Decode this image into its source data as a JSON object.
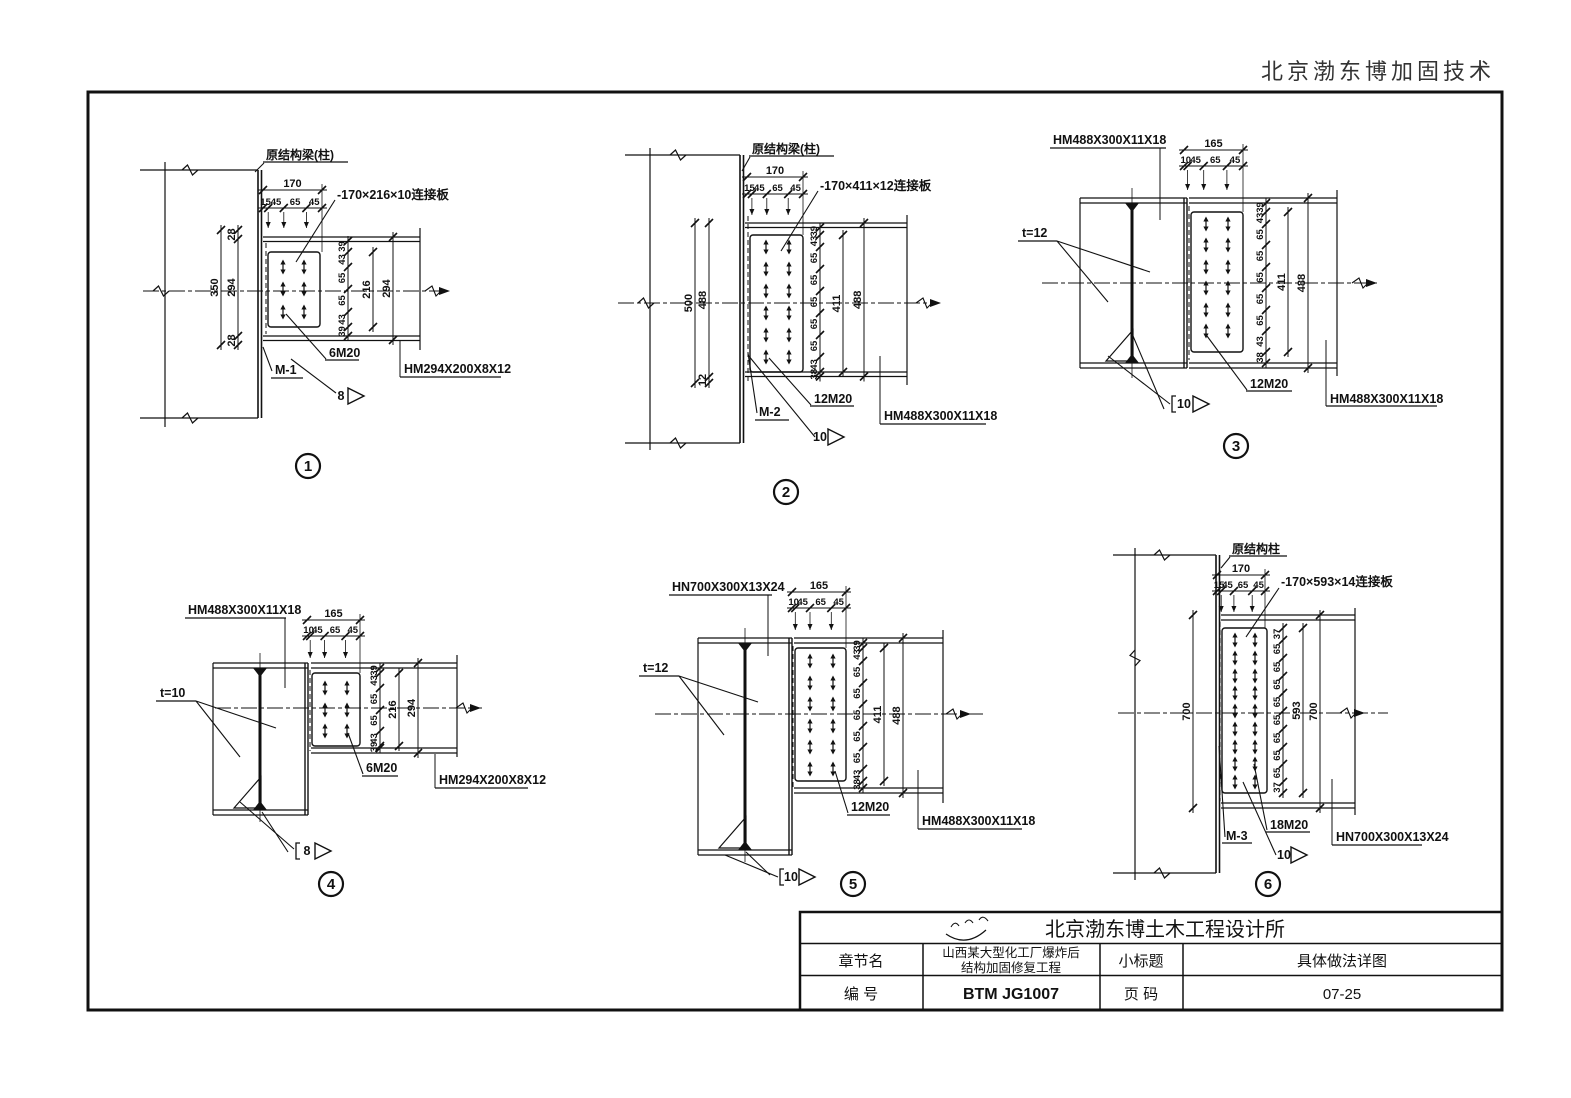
{
  "page": {
    "brand": "北京渤东博加固技术"
  },
  "details": [
    {
      "number": "1",
      "support": "原结构梁(柱)",
      "plate": "-170×216×10连接板",
      "bolts": "6M20",
      "mark": "M-1",
      "weld": "8",
      "beam": "HM294X200X8X12",
      "top_total": "170",
      "top_chain": [
        "15",
        "45",
        "65",
        "45"
      ],
      "left_overall": "350",
      "left_chain": [
        "28",
        "294",
        "28"
      ],
      "right_chain": [
        "39",
        "43",
        "65",
        "65",
        "43",
        "39"
      ],
      "plate_h": "216",
      "depth": "294"
    },
    {
      "number": "2",
      "support": "原结构梁(柱)",
      "plate": "-170×411×12连接板",
      "bolts": "12M20",
      "mark": "M-2",
      "weld": "10",
      "beam": "HM488X300X11X18",
      "top_total": "170",
      "top_chain": [
        "15",
        "45",
        "65",
        "45"
      ],
      "left_overall": "500",
      "left_chain": [
        "488",
        "12"
      ],
      "right_chain": [
        "39",
        "43",
        "65",
        "65",
        "65",
        "65",
        "65",
        "43",
        "38"
      ],
      "plate_h": "411",
      "depth": "488"
    },
    {
      "number": "3",
      "member": "HM488X300X11X18",
      "t": "t=12",
      "bolts": "12M20",
      "weld": "10",
      "beam": "HM488X300X11X18",
      "top_total": "165",
      "top_chain": [
        "10",
        "45",
        "65",
        "45"
      ],
      "right_chain": [
        "39",
        "43",
        "65",
        "65",
        "65",
        "65",
        "65",
        "43",
        "38"
      ],
      "plate_h": "411",
      "depth": "488"
    },
    {
      "number": "4",
      "member": "HM488X300X11X18",
      "t": "t=10",
      "bolts": "6M20",
      "weld": "8",
      "beam": "HM294X200X8X12",
      "top_total": "165",
      "top_chain": [
        "10",
        "45",
        "65",
        "45"
      ],
      "right_chain": [
        "39",
        "43",
        "65",
        "65",
        "43",
        "39"
      ],
      "plate_h": "216",
      "depth": "294"
    },
    {
      "number": "5",
      "member": "HN700X300X13X24",
      "t": "t=12",
      "bolts": "12M20",
      "weld": "10",
      "beam": "HM488X300X11X18",
      "top_total": "165",
      "top_chain": [
        "10",
        "45",
        "65",
        "45"
      ],
      "right_chain": [
        "39",
        "43",
        "65",
        "65",
        "65",
        "65",
        "65",
        "43",
        "38"
      ],
      "plate_h": "411",
      "depth": "488"
    },
    {
      "number": "6",
      "support": "原结构柱",
      "plate": "-170×593×14连接板",
      "bolts": "18M20",
      "mark": "M-3",
      "weld": "10",
      "beam": "HN700X300X13X24",
      "top_total": "170",
      "top_chain": [
        "15",
        "45",
        "65",
        "45"
      ],
      "left_overall": "700",
      "right_chain": [
        "37",
        "65",
        "65",
        "65",
        "65",
        "65",
        "65",
        "65",
        "65",
        "37"
      ],
      "plate_h": "593",
      "depth": "700"
    }
  ],
  "titleblock": {
    "company": "北京渤东博土木工程设计所",
    "chapter_label": "章节名",
    "chapter_value_1": "山西某大型化工厂爆炸后",
    "chapter_value_2": "结构加固修复工程",
    "subtitle_label": "小标题",
    "subtitle_value": "具体做法详图",
    "code_label": "编  号",
    "code_value": "BTM JG1007",
    "page_label": "页  码",
    "page_value": "07-25"
  }
}
